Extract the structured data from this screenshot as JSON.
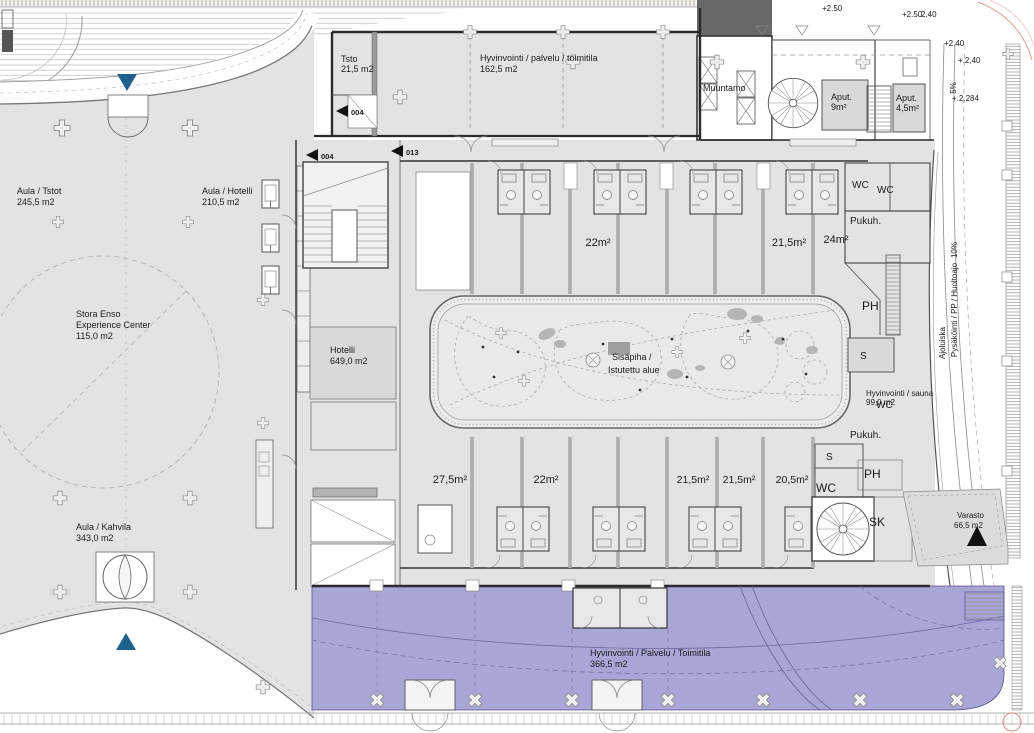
{
  "drawing": {
    "spaces": {
      "aula_tstot": {
        "name": "Aula / Tstot",
        "area": "245,5 m2"
      },
      "aula_hotelli": {
        "name": "Aula / Hotelli",
        "area": "210,5 m2"
      },
      "aula_kahvila": {
        "name": "Aula / Kahvila",
        "area": "343,0 m2"
      },
      "stora_enso": {
        "name1": "Stora Enso",
        "name2": "Experience Center",
        "area": "115,0 m2"
      },
      "tsto": {
        "name": "Tsto",
        "area": "21,5 m2"
      },
      "hall": {
        "name": "Hyvinvointi / palvelu / toimitila",
        "area": "162,5 m2"
      },
      "hotelli": {
        "name": "Hotelli",
        "area": "649,0 m2"
      },
      "muuntamo": {
        "name": "Muuntamo"
      },
      "aput_9": {
        "name": "Aput.",
        "area": "9m²"
      },
      "aput_45": {
        "name": "Aput.",
        "area": "4,5m²"
      },
      "sisapiha": {
        "name1": "Sisäpiha /",
        "name2": "Istutettu alue"
      },
      "sauna_suite": {
        "name": "Hyvinvointi / sauna",
        "area": "99,0 m2"
      },
      "varasto": {
        "name": "Varasto",
        "area": "66,5 m2"
      },
      "wellness_south": {
        "name": "Hyvinvointi / Palvelu / Toimitila",
        "area": "366,5 m2"
      }
    },
    "rooms_upper": [
      {
        "label": "22m²"
      },
      {
        "label": "21,5m²"
      },
      {
        "label": "24m²"
      }
    ],
    "rooms_lower": [
      {
        "label": "27,5m²"
      },
      {
        "label": "22m²"
      },
      {
        "label": "21,5m²"
      },
      {
        "label": "21,5m²"
      },
      {
        "label": "20,5m²"
      }
    ],
    "service_labels": {
      "wc_a": "WC",
      "wc_b": "WC",
      "pukuh_n": "Pukuh.",
      "ph_n": "PH",
      "s_n": "S",
      "wc_mid": "WC",
      "pukuh_s": "Pukuh.",
      "s_s": "S",
      "ph_s": "PH",
      "wc_s": "WC",
      "sk": "SK"
    },
    "levels": {
      "a": "+2.50",
      "b": "+2.50",
      "c": "2.40",
      "d": "+2.40",
      "e": "+.2,40",
      "f": "+.2,284",
      "slope": "5%"
    },
    "door_tags": {
      "t1": "004",
      "t2": "004",
      "t3": "013"
    },
    "ramp": {
      "line1": "Ajoluiska",
      "line2": "Pysäköinti / PP / Huoltoajo",
      "slope": "10%"
    },
    "colors": {
      "floor": "#e3e3e3",
      "floor_light": "#ececec",
      "accent_purple": "#a8a6d6",
      "entrance_blue": "#1e628d",
      "wall": "#2b2b2b",
      "room_gray": "#d9d9d9",
      "dark_block": "#686868",
      "site_pink": "#dfa49c"
    }
  }
}
